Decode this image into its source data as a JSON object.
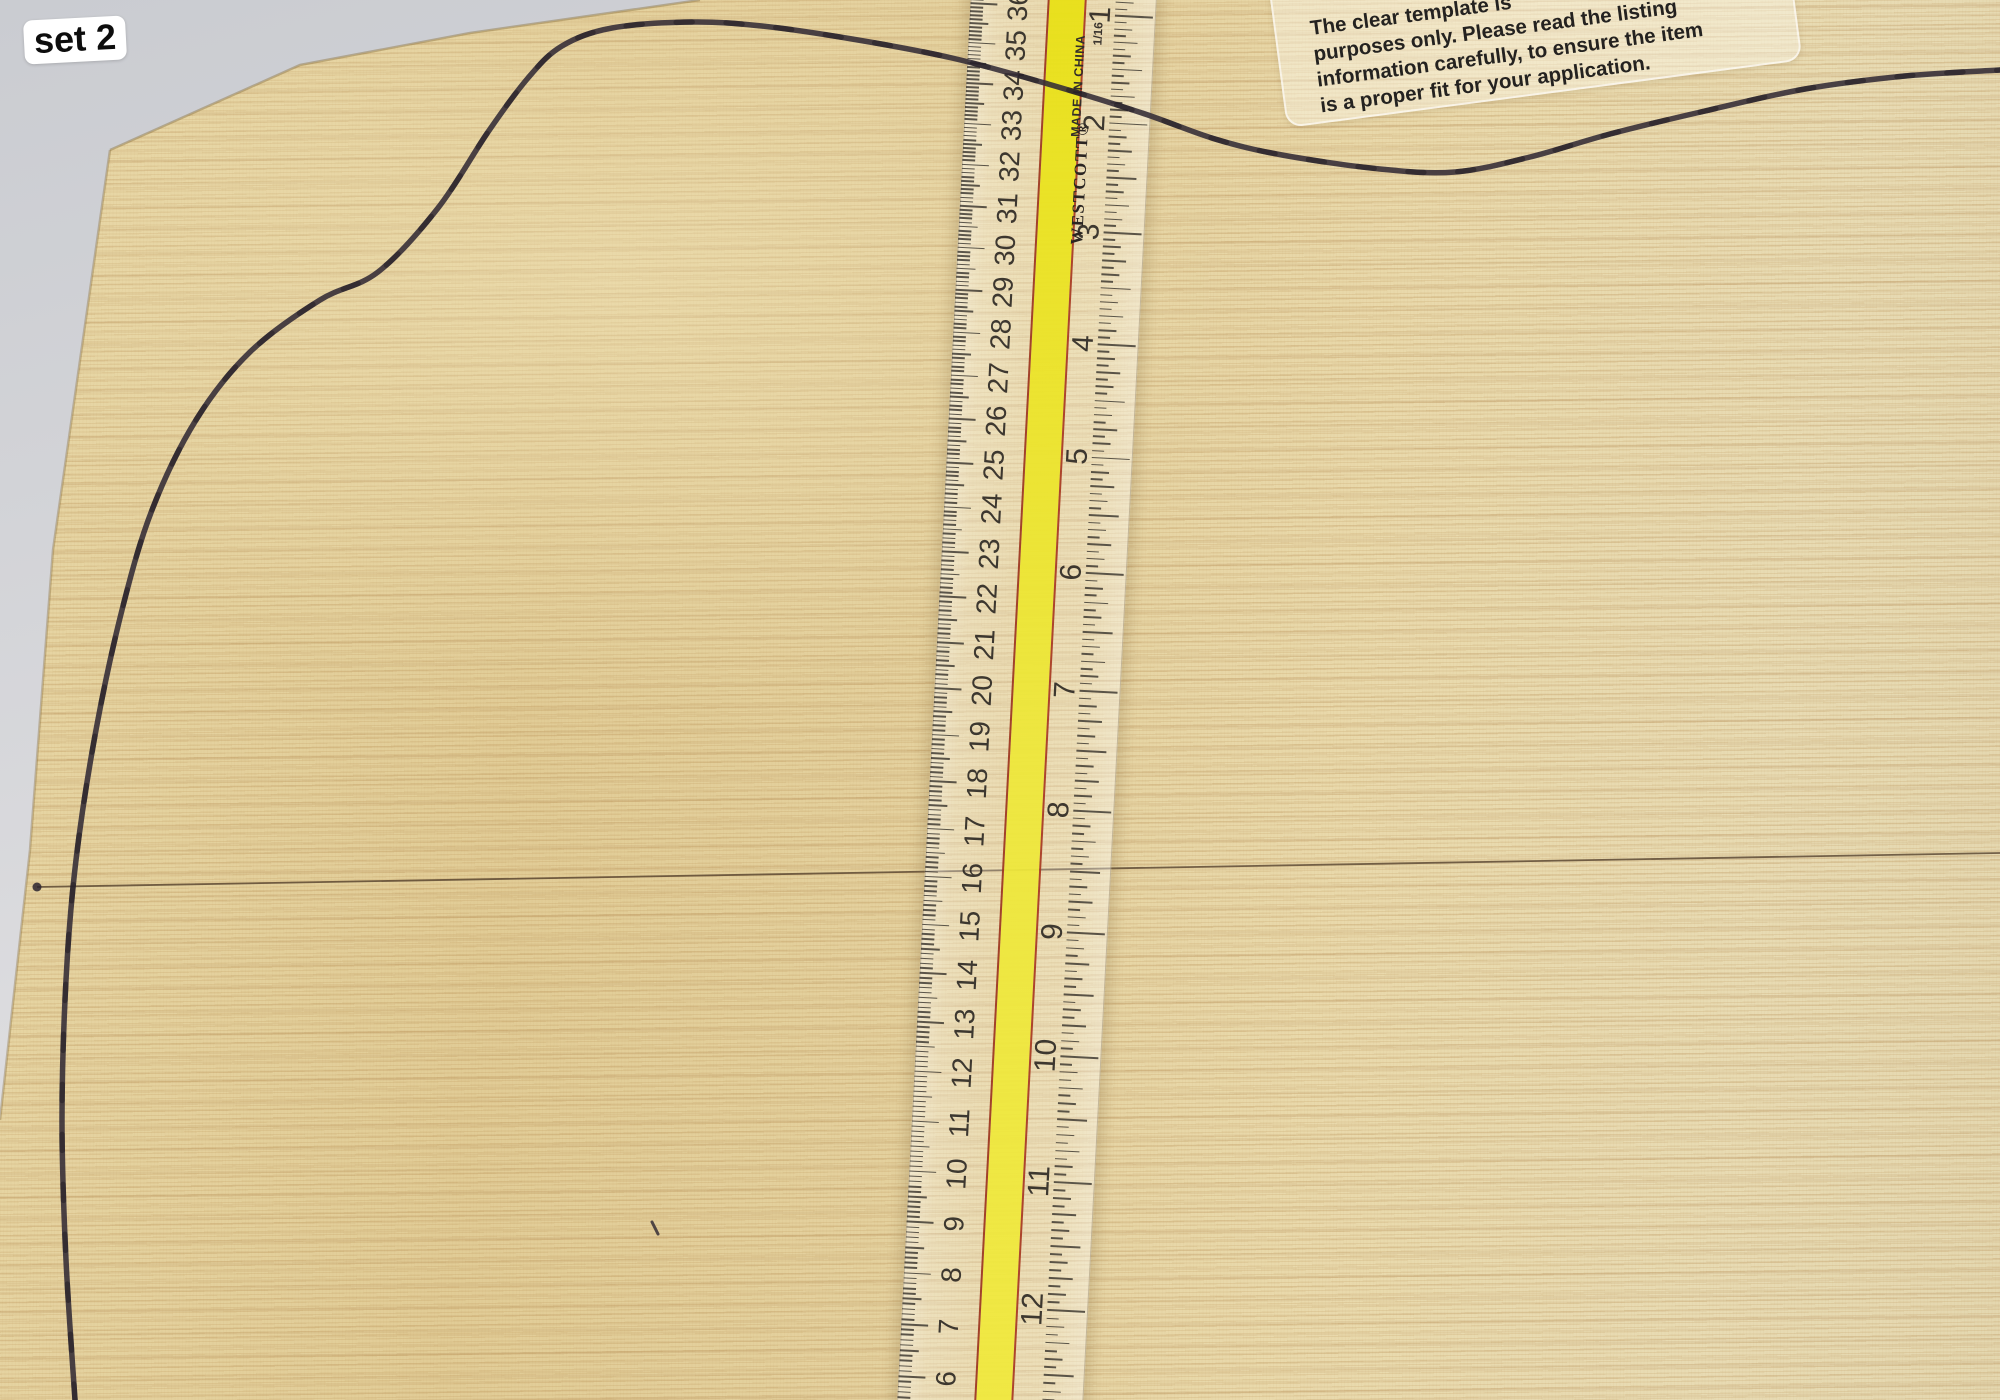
{
  "scene": {
    "badge_label": "set 2",
    "sticker": {
      "lines": [
        "The clear template is",
        "purposes only. Please read the listing",
        "information carefully, to ensure the item",
        "is a proper fit for your application."
      ]
    },
    "ruler": {
      "brand": "WESTCOTT®",
      "origin_label": "MADE IN CHINA",
      "fraction_label": "1/16",
      "cm_numbers": [
        36,
        35,
        34,
        33,
        32,
        31,
        30,
        29,
        28,
        27,
        26,
        25,
        24,
        23,
        22,
        21,
        20,
        19,
        18,
        17,
        16,
        15,
        14,
        13,
        12,
        11,
        10,
        9,
        8,
        7,
        6
      ],
      "inch_numbers": [
        1,
        2,
        3,
        4,
        5,
        6,
        7,
        8,
        9,
        10,
        11,
        12
      ]
    },
    "outline_points": [
      [
        75,
        1400
      ],
      [
        66,
        1260
      ],
      [
        62,
        1120
      ],
      [
        66,
        980
      ],
      [
        76,
        860
      ],
      [
        96,
        730
      ],
      [
        122,
        610
      ],
      [
        152,
        510
      ],
      [
        196,
        420
      ],
      [
        250,
        352
      ],
      [
        320,
        300
      ],
      [
        378,
        272
      ],
      [
        438,
        208
      ],
      [
        488,
        132
      ],
      [
        528,
        78
      ],
      [
        562,
        46
      ],
      [
        612,
        28
      ],
      [
        692,
        22
      ],
      [
        762,
        26
      ],
      [
        852,
        39
      ],
      [
        952,
        58
      ],
      [
        1048,
        84
      ],
      [
        1142,
        113
      ],
      [
        1215,
        139
      ],
      [
        1282,
        155
      ],
      [
        1380,
        169
      ],
      [
        1455,
        172
      ],
      [
        1530,
        157
      ],
      [
        1610,
        134
      ],
      [
        1705,
        111
      ],
      [
        1805,
        89
      ],
      [
        1905,
        76
      ],
      [
        2000,
        70
      ]
    ],
    "center_seam": {
      "x1": 37,
      "y1": 887,
      "x2": 2000,
      "y2": 853
    },
    "marks": [
      {
        "type": "dot",
        "x": 37,
        "y": 887,
        "r": 4.5
      },
      {
        "type": "dash",
        "x": 655,
        "y": 1228
      }
    ],
    "colors": {
      "wood_left": "#e2cf9d",
      "wood_right": "#e9dcb2",
      "background_gray": "#d2d3d7",
      "ruler_yellow": "#ece41f",
      "ruler_red_edge": "#a83a22",
      "outline_stroke": "#332b36",
      "seam_stroke": "#55412d"
    }
  }
}
